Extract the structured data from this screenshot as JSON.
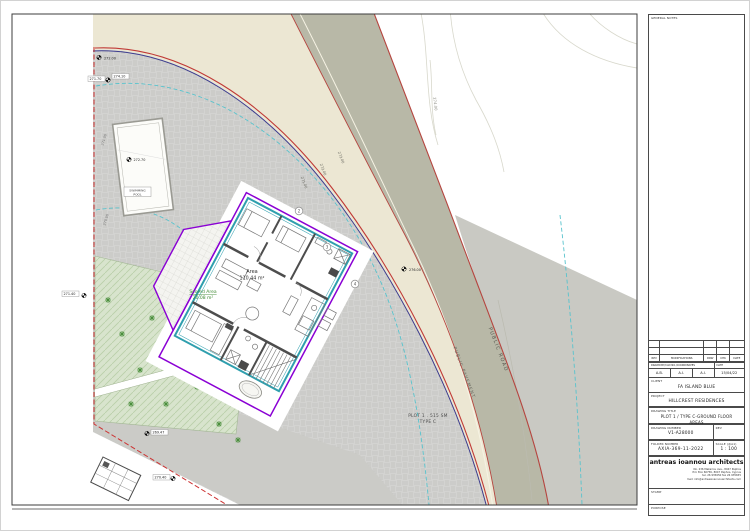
{
  "title_block": {
    "general_notes_label": "GENERAL NOTES",
    "rev_headers": [
      "REV",
      "MODIFICATIONS",
      "DRW",
      "CHK",
      "DATE"
    ],
    "drawn_header": "DRAWN BY/CAD NO./COORDINATES",
    "drawn_date_label": "DATE",
    "drawn_by": "A.B.",
    "cad_no": "A.I.",
    "coordinates": "A.I.",
    "date": "15/04/22",
    "client_label": "CLIENT",
    "client": "FA ISLAND BLUE",
    "project_label": "PROJECT",
    "project": "HILLCREST RESIDENCES",
    "drawing_title_label": "DRAWING TITLE",
    "drawing_title_line1": "PLOT 1 / TYPE C-GROUND FLOOR",
    "drawing_title_line2": "AREAS",
    "drawing_number_label": "DRAWING NUMBER",
    "drawing_number": "V1-A28000",
    "rev_label": "REV",
    "rev_value": "",
    "folder_label": "FOLDER NUMBER",
    "folder_number": "AXIA-369-11-2022",
    "scale_label": "SCALE (@A1)",
    "scale": "1 : 100",
    "firm_name": "antreas ioannou architects",
    "address_line1": "No. 236 Makariou Ave., 8047 Paphos",
    "address_line2": "P.O. Box 60756, 8047 Paphos, Cyprus",
    "address_line3": "tel. 26 935650   fax 26 935655",
    "address_line4": "mail: info@antreasioannouarchitects.com",
    "stamp_label": "STAMP",
    "purpose_label": "PURPOSE"
  },
  "plan": {
    "public_road_label": "PUBLIC ROAD",
    "public_pavement_label": "PUBLIC PAVEMENT",
    "plot_label_line1": "PLOT 1 . 515 SM",
    "plot_label_line2": "TYPE C",
    "area_label": "Area",
    "area_value": "110.44 m²",
    "scored_area_label": "Scored Area",
    "scored_area_value": "20.08 m²",
    "pool_label_line1": "SWIMMING",
    "pool_label_line2": "POOL",
    "contour_271": "271.00",
    "contour_272": "272.00",
    "contour_273": "273.00",
    "contour_274": "274.00",
    "boundary_level_upper": "271.00",
    "boundary_level_lower": "270.00",
    "spot_272_00": "272.00",
    "spot_271_70": "271.70",
    "spot_274_10": "274.10",
    "spot_272_70": "272.70",
    "spot_276_00": "276.00",
    "spot_271_40": "271.40",
    "spot_269_47": "269.47",
    "spot_270_40": "270.40",
    "survey_point_2": "2",
    "survey_point_3": "3",
    "survey_point_4": "4"
  },
  "colors": {
    "road": "#b8b8a7",
    "pavement": "#ece7d3",
    "site_base": "#d3d3d1",
    "far_land": "#c9c9c3",
    "lawn": "#d8e4cd",
    "boundary_red": "#c03a36",
    "boundary_blue": "#3c3c8e",
    "outline_purple": "#8a00d4",
    "building_teal": "#2f9fae",
    "contour_cyan": "#58c3cd",
    "scored_green": "#3f8a33",
    "red_dashed": "#cc3333"
  }
}
